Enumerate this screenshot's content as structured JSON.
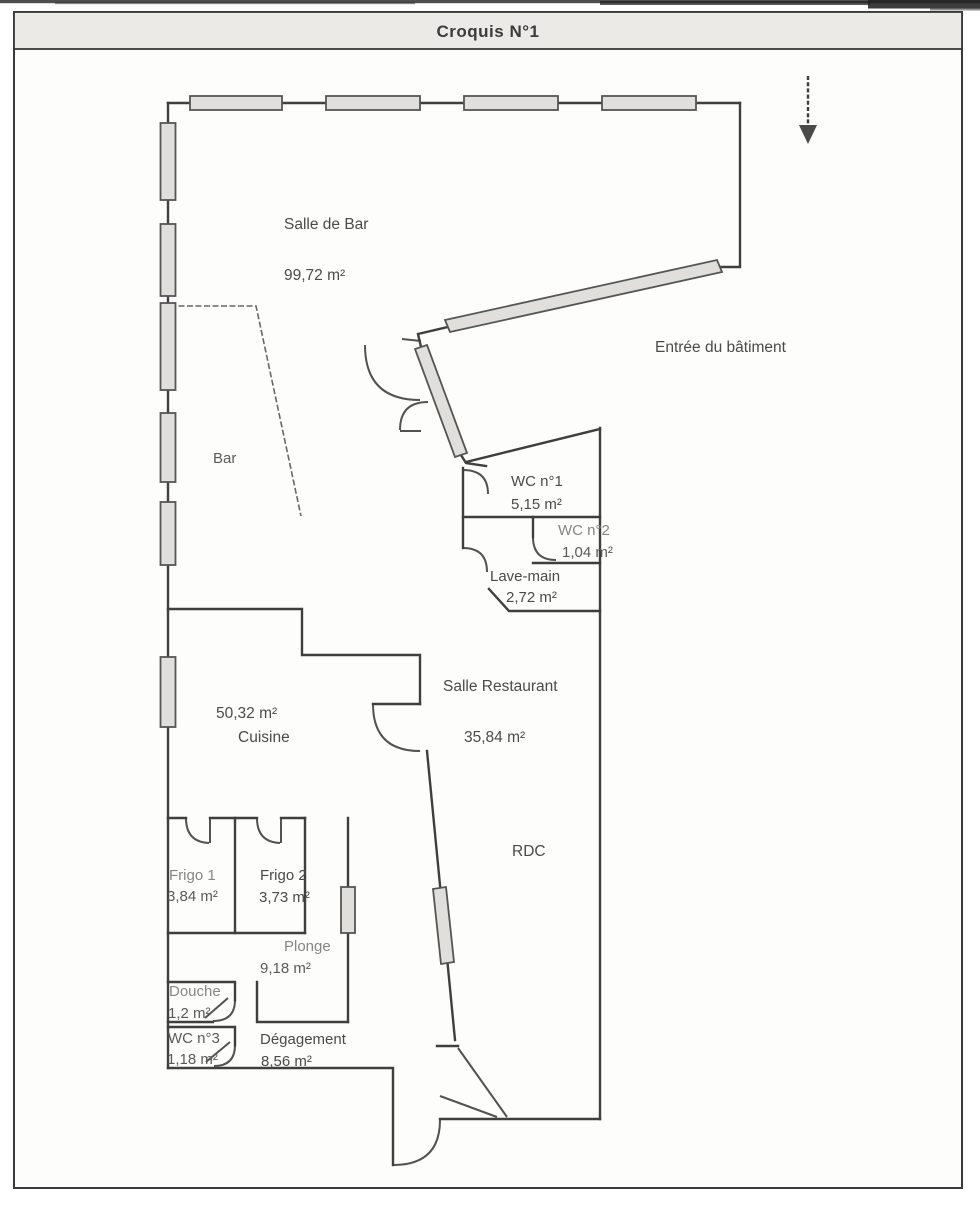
{
  "title": "Croquis N°1",
  "labels": {
    "salle_de_bar": {
      "name": "Salle de Bar",
      "area": "99,72 m²"
    },
    "bar": {
      "name": "Bar"
    },
    "entree": {
      "name": "Entrée du bâtiment"
    },
    "wc1": {
      "name": "WC n°1",
      "area": "5,15 m²"
    },
    "wc2": {
      "name": "WC n°2",
      "area": "1,04 m²"
    },
    "lave_main": {
      "name": "Lave-main",
      "area": "2,72 m²"
    },
    "salle_restaurant": {
      "name": "Salle Restaurant",
      "area": "35,84 m²"
    },
    "cuisine": {
      "name": "Cuisine",
      "area": "50,32 m²"
    },
    "rdc": {
      "name": "RDC"
    },
    "frigo_1": {
      "name": "Frigo 1",
      "area": "3,84 m²"
    },
    "frigo_2": {
      "name": "Frigo 2",
      "area": "3,73 m²"
    },
    "plonge": {
      "name": "Plonge",
      "area": "9,18 m²"
    },
    "douche": {
      "name": "Douche",
      "area": "1,2 m²"
    },
    "wc3": {
      "name": "WC n°3",
      "area": "1,18 m²"
    },
    "degagement": {
      "name": "Dégagement",
      "area": "8,56 m²"
    }
  },
  "colors": {
    "wall": "#3f3f3f",
    "window_fill": "#e0dfdc",
    "paper": "#fdfdfb",
    "title_bar": "#eceae6",
    "ink": "#4a4a4a",
    "ink_light": "#868686"
  }
}
